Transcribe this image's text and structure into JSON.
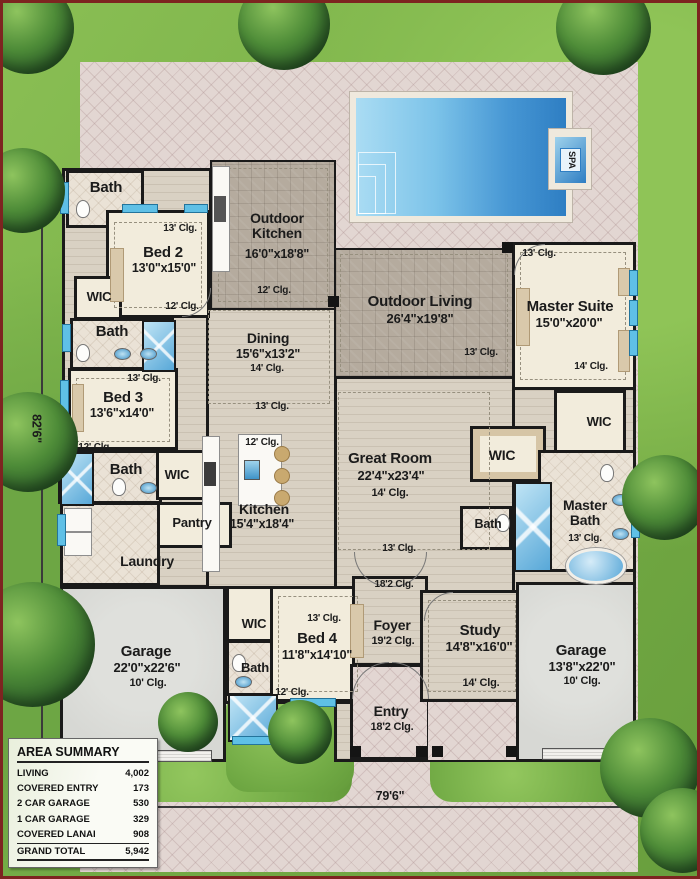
{
  "labels": {
    "bath": "Bath",
    "wic": "WIC",
    "spa": "SPA"
  },
  "dimensions": {
    "lot_width": "79'6\"",
    "lot_height": "82'6\""
  },
  "rooms": {
    "bed2": {
      "name": "Bed 2",
      "size": "13'0\"x15'0\"",
      "clg_top": "13' Clg.",
      "clg_bottom": "12' Clg."
    },
    "bed3": {
      "name": "Bed 3",
      "size": "13'6\"x14'0\"",
      "clg_top": "13' Clg.",
      "clg_bottom": "12' Clg."
    },
    "bed4": {
      "name": "Bed 4",
      "size": "11'8\"x14'10\"",
      "clg_top": "13' Clg.",
      "clg_bottom": "12' Clg."
    },
    "master_suite": {
      "name": "Master Suite",
      "size": "15'0\"x20'0\"",
      "clg_top": "13' Clg.",
      "clg_bottom": "14' Clg."
    },
    "master_bath": {
      "name": "Master Bath",
      "clg": "13' Clg."
    },
    "outdoor_kitchen": {
      "name": "Outdoor Kitchen",
      "size": "16'0\"x18'8\"",
      "clg": "12' Clg."
    },
    "outdoor_living": {
      "name": "Outdoor Living",
      "size": "26'4\"x19'8\"",
      "clg": "13' Clg."
    },
    "dining": {
      "name": "Dining",
      "size": "15'6\"x13'2\"",
      "clg": "14' Clg.",
      "clg_bottom": "13' Clg."
    },
    "great_room": {
      "name": "Great Room",
      "size": "22'4\"x23'4\"",
      "clg": "14' Clg.",
      "clg_bottom": "13' Clg."
    },
    "kitchen": {
      "name": "Kitchen",
      "size": "15'4\"x18'4\"",
      "clg_top": "12' Clg."
    },
    "pantry": {
      "name": "Pantry"
    },
    "laundry": {
      "name": "Laundry"
    },
    "foyer": {
      "name": "Foyer",
      "clg": "19'2 Clg.",
      "clg_top": "18'2 Clg."
    },
    "entry": {
      "name": "Entry",
      "clg": "18'2 Clg."
    },
    "study": {
      "name": "Study",
      "size": "14'8\"x16'0\"",
      "clg": "14' Clg."
    },
    "garage_left": {
      "name": "Garage",
      "size": "22'0\"x22'6\"",
      "clg": "10' Clg."
    },
    "garage_right": {
      "name": "Garage",
      "size": "13'8\"x22'0\"",
      "clg": "10' Clg."
    }
  },
  "area_summary": {
    "title": "AREA SUMMARY",
    "rows": [
      {
        "label": "LIVING",
        "value": "4,002"
      },
      {
        "label": "COVERED ENTRY",
        "value": "173"
      },
      {
        "label": "2 CAR GARAGE",
        "value": "530"
      },
      {
        "label": "1 CAR GARAGE",
        "value": "329"
      },
      {
        "label": "COVERED LANAI",
        "value": "908"
      }
    ],
    "total": {
      "label": "GRAND TOTAL",
      "value": "5,942"
    }
  },
  "colors": {
    "pool": "#3a8fd0",
    "lawn": "#7cb14b",
    "paver": "#e0d4d0",
    "wall": "#161616",
    "window": "#5fc0e6"
  }
}
